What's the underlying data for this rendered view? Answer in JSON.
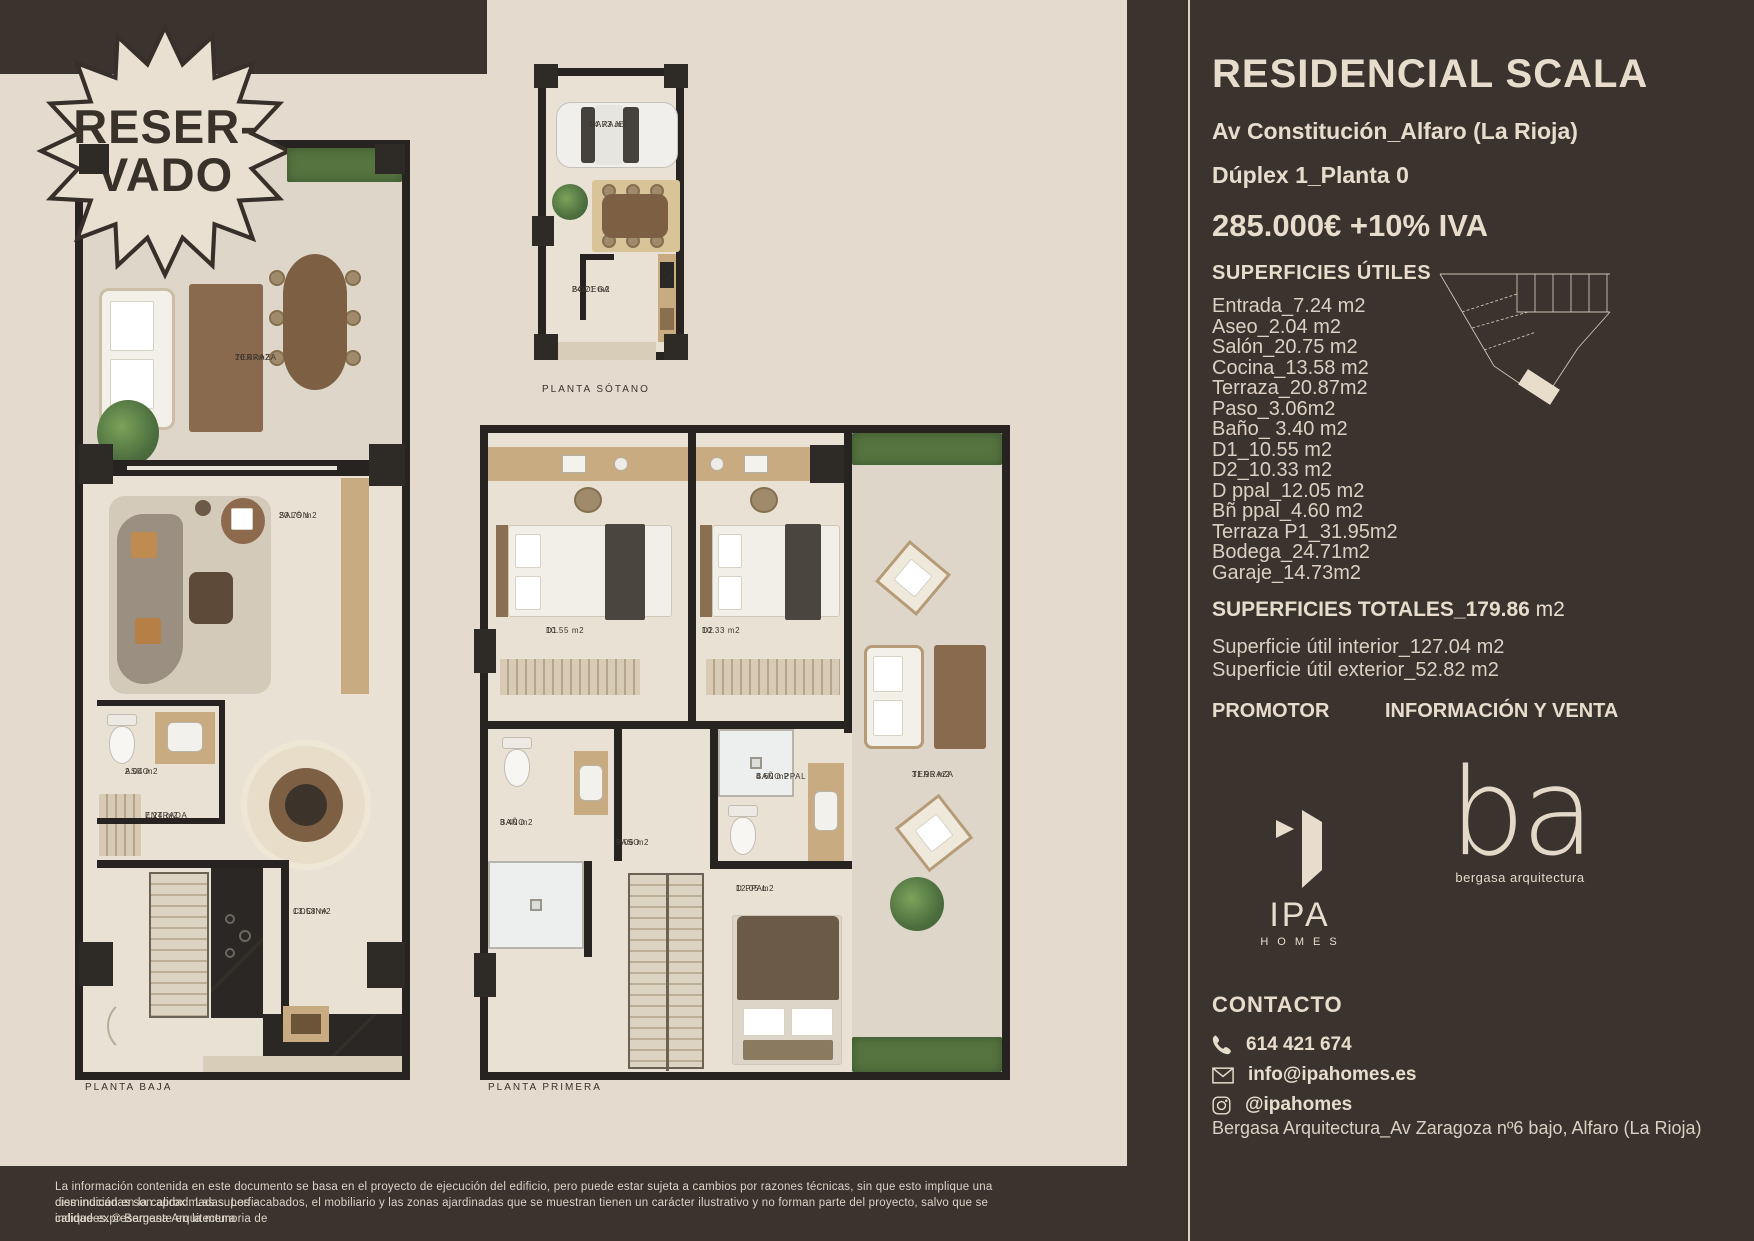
{
  "badge": {
    "line1": "RESER-",
    "line2": "VADO"
  },
  "plans": {
    "sotano": {
      "title": "PLANTA SÓTANO",
      "garaje_name": "GARAJE",
      "garaje_area": "14.73 m2",
      "bodega_name": "BODEGA",
      "bodega_area": "24.71 m2"
    },
    "baja": {
      "title": "PLANTA BAJA",
      "terraza_name": "TERRAZA",
      "terraza_area": "20.87m2",
      "salon_name": "SALÓN",
      "salon_area": "20.75 m2",
      "aseo_name": "ASEO",
      "aseo_area": "2.04 m2",
      "entrada_name": "ENTRADA",
      "entrada_area": "7.24 m2",
      "cocina_name": "COCINA",
      "cocina_area": "13.58 m2"
    },
    "primera": {
      "title": "PLANTA PRIMERA",
      "d1_name": "D1",
      "d1_area": "10.55 m2",
      "d2_name": "D2",
      "d2_area": "10.33 m2",
      "bano_name": "BAÑO",
      "bano_area": "3.40 m2",
      "paso_name": "PASO",
      "paso_area": "3.06 m2",
      "banoppal_name": "BAÑO PPAL",
      "banoppal_area": "4.60 m2",
      "dppal_name": "D PPAL",
      "dppal_area": "12.05 m2",
      "terraza_name": "TERRAZA",
      "terraza_area": "31.95 m2"
    }
  },
  "panel": {
    "title": "RESIDENCIAL SCALA",
    "address": "Av Constitución_Alfaro (La Rioja)",
    "unit": "Dúplex 1_Planta 0",
    "price": "285.000€ +10% IVA",
    "superficies_heading": "SUPERFICIES ÚTILES",
    "superficies": [
      "Entrada_7.24 m2",
      "Aseo_2.04 m2",
      "Salón_20.75 m2",
      "Cocina_13.58 m2",
      "Terraza_20.87m2",
      "Paso_3.06m2",
      "Baño_ 3.40 m2",
      "D1_10.55 m2",
      "D2_10.33 m2",
      "D ppal_12.05 m2",
      "Bñ ppal_4.60 m2",
      "Terraza P1_31.95m2",
      "Bodega_24.71m2",
      "Garaje_14.73m2"
    ],
    "totales_bold": "SUPERFICIES TOTALES_179.86",
    "totales_rest": " m2",
    "interior": "Superficie útil interior_127.04 m2",
    "exterior": "Superficie útil exterior_52.82 m2",
    "promotor_heading": "PROMOTOR",
    "venta_heading": "INFORMACIÓN Y VENTA",
    "ipa_name": "IPA",
    "ipa_sub": "HOMES",
    "ba_name": "ba",
    "ba_sub": "bergasa arquitectura",
    "contacto_heading": "CONTACTO",
    "phone": "614 421 674",
    "email": "info@ipahomes.es",
    "instagram": "@ipahomes",
    "architect": "Bergasa Arquitectura_Av Zaragoza nº6 bajo, Alfaro (La Rioja)"
  },
  "footer": {
    "line1": "La información contenida en este documento se basa en el proyecto de ejecución del edificio, pero puede estar sujeta a cambios por razones técnicas, sin que esto implique una disminución en la calidad. Las superfi-",
    "line2": "cies indicadas son aproximadas. Los acabados, el mobiliario y las zonas ajardinadas que se muestran tienen un carácter ilustrativo y no forman parte del proyecto, salvo que se indique expresamente en la memoria de",
    "line3": "calidades.  © Bergasa Arquitectura"
  }
}
